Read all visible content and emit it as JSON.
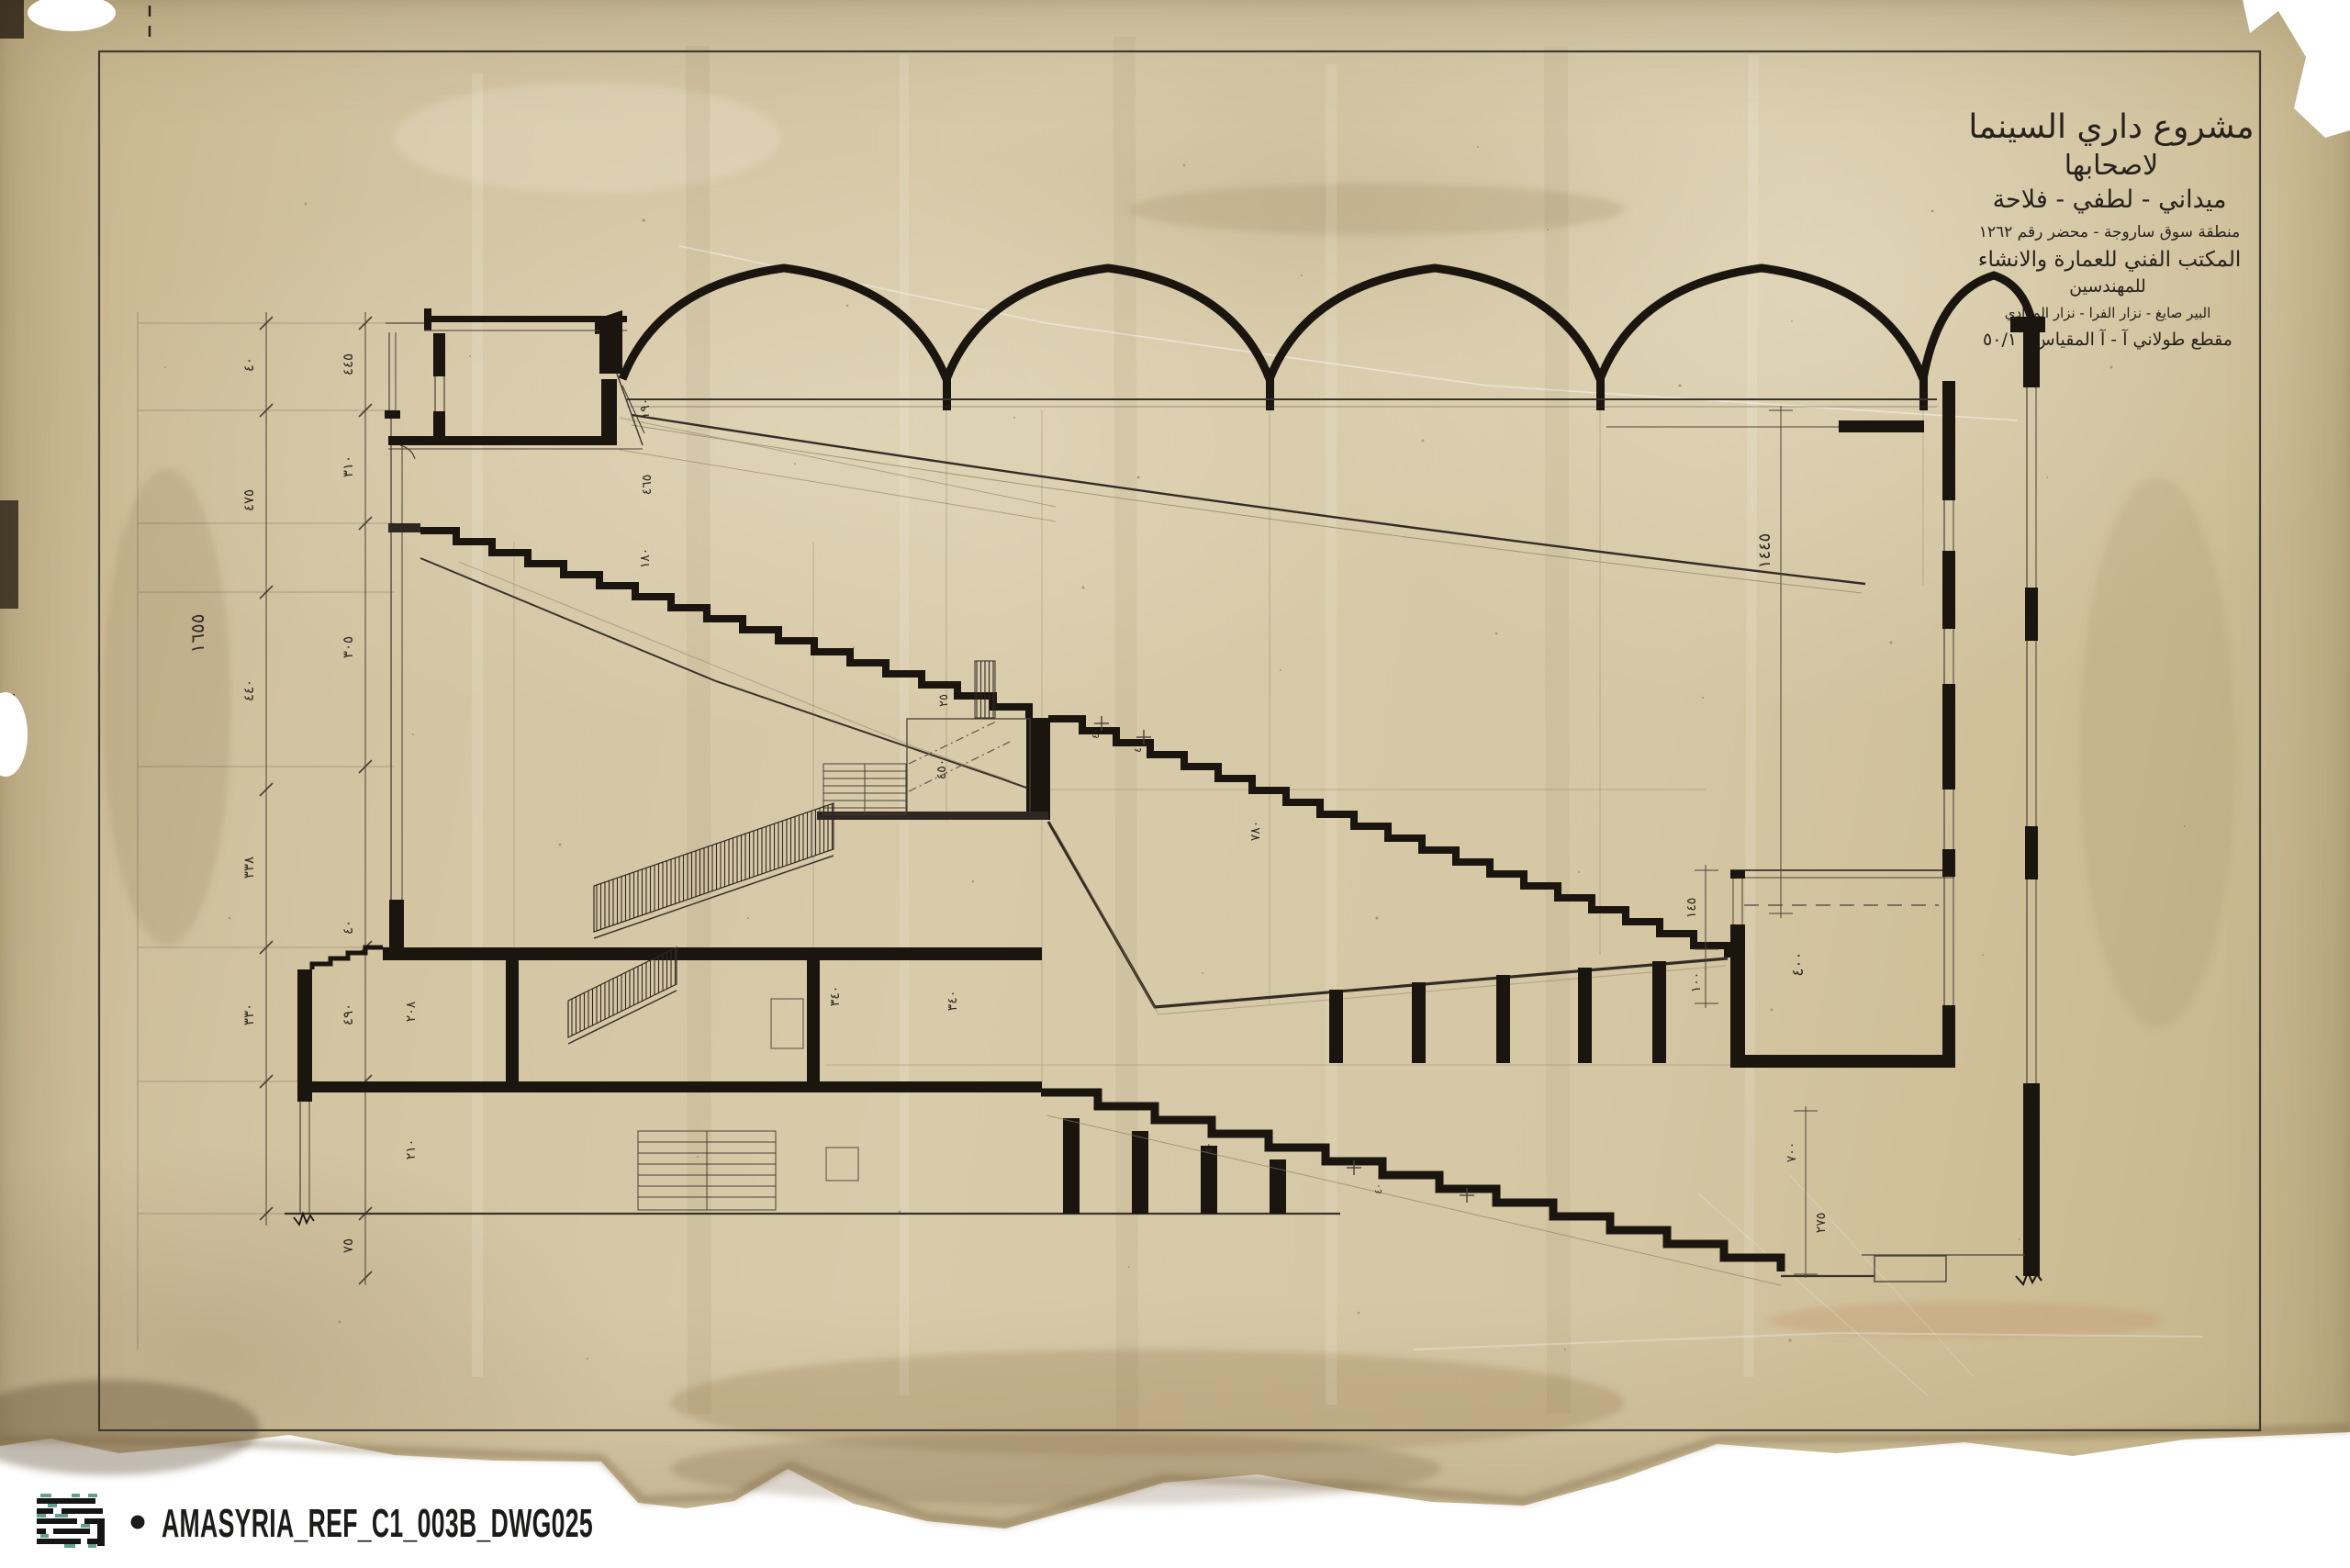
{
  "colors": {
    "paper": "#d5c7a4",
    "paper_edge": "#c2b087",
    "ink": "#1a150e",
    "ink_medium": "#332c23",
    "line_thin": "#4a4136",
    "pencil": "#8b7d63",
    "logo_teal": "#63a090",
    "background": "#ffffff"
  },
  "title_block": {
    "l1": "مشروع داري السينما",
    "l2": "لاصحابها",
    "l3": "ميداني - لطفي - فلاحة",
    "l4": "منطقة سوق ساروجة - محضر رقم ١٢٦٢",
    "l5": "المكتب الفني للعمارة والانشاء",
    "l6": "للمهندسين",
    "l7": "البير صايغ - نزار الفرا - نزار المرادي",
    "l8": "مقطع طولاني آ - آ   المقياس : ٥٠/١"
  },
  "dims": {
    "chain1": [
      "٤٠",
      "٤٧٥",
      "٤٤٠",
      "٣٣٨",
      "٣٣٠"
    ],
    "chain1_total": "١٦٥٥",
    "chain2": [
      "٤٤٥",
      "٣١٠",
      "٣٠٥",
      "٤٠",
      "٤٩٠",
      "٧٥"
    ]
  },
  "annotations": [
    {
      "t": "١٩٠"
    },
    {
      "t": "٤٦٥"
    },
    {
      "t": "١٨٠"
    },
    {
      "t": "٢٥"
    },
    {
      "t": "٤٥٠"
    },
    {
      "t": "٣٤٠"
    },
    {
      "t": "٣٤٠"
    },
    {
      "t": "٤٠"
    },
    {
      "t": "٤٠"
    },
    {
      "t": "٧٨٠"
    },
    {
      "t": "١٤٥"
    },
    {
      "t": "١٠٠"
    },
    {
      "t": "٤٠٠"
    },
    {
      "t": "١٤٤٥"
    },
    {
      "t": "٧٠٠"
    },
    {
      "t": "٢٧٥"
    },
    {
      "t": "٢٠٨"
    },
    {
      "t": "٢١٠"
    },
    {
      "t": "٤٠"
    },
    {
      "t": "٤٠"
    }
  ],
  "footer": {
    "bullet": "•",
    "reference": "AMASYRIA_REF_C1_003B_DWG025"
  }
}
